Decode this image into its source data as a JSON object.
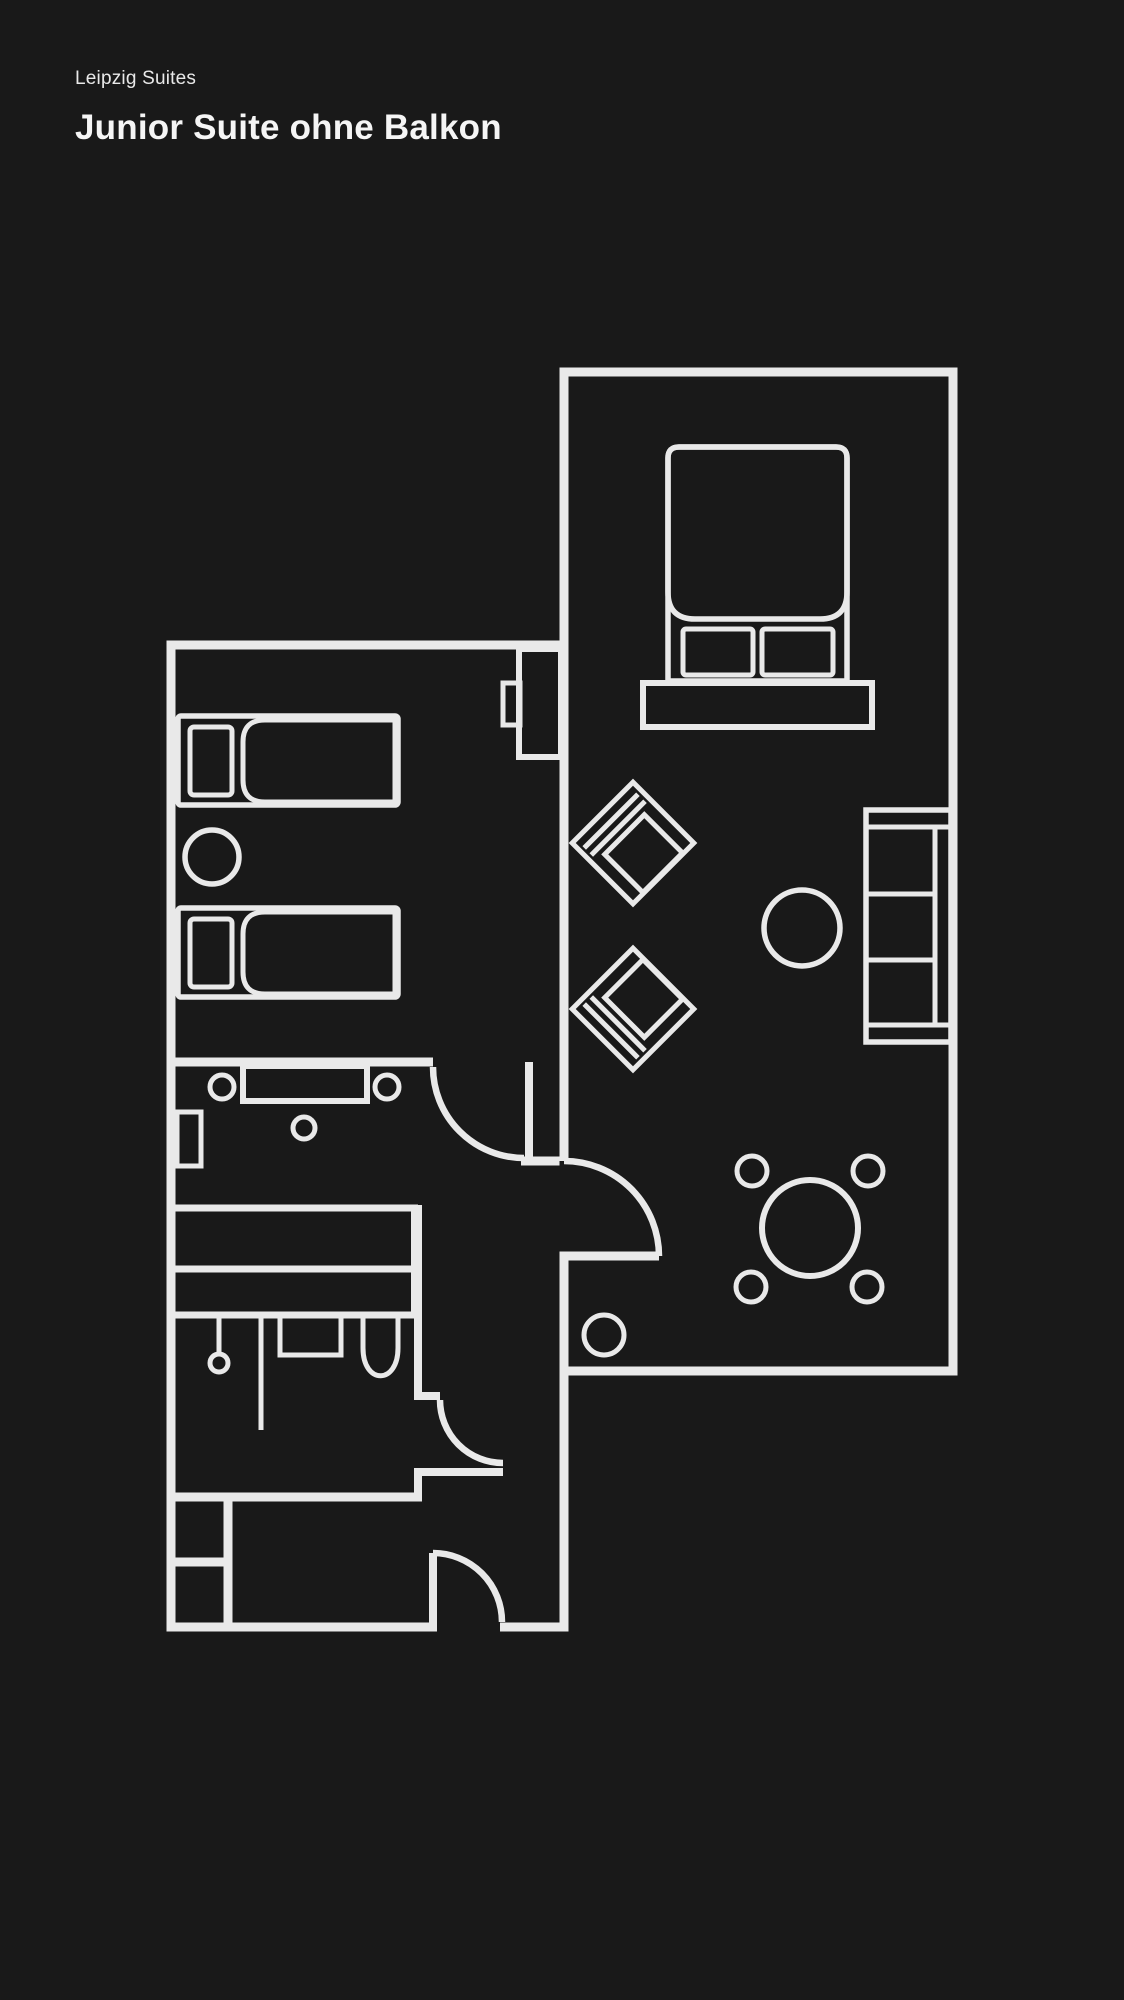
{
  "page": {
    "background_color": "#191919",
    "line_color": "#e9e9e9",
    "text_color": "#f5f5f5"
  },
  "header": {
    "brand": "Leipzig Suites",
    "title": "Junior Suite ohne Balkon"
  }
}
